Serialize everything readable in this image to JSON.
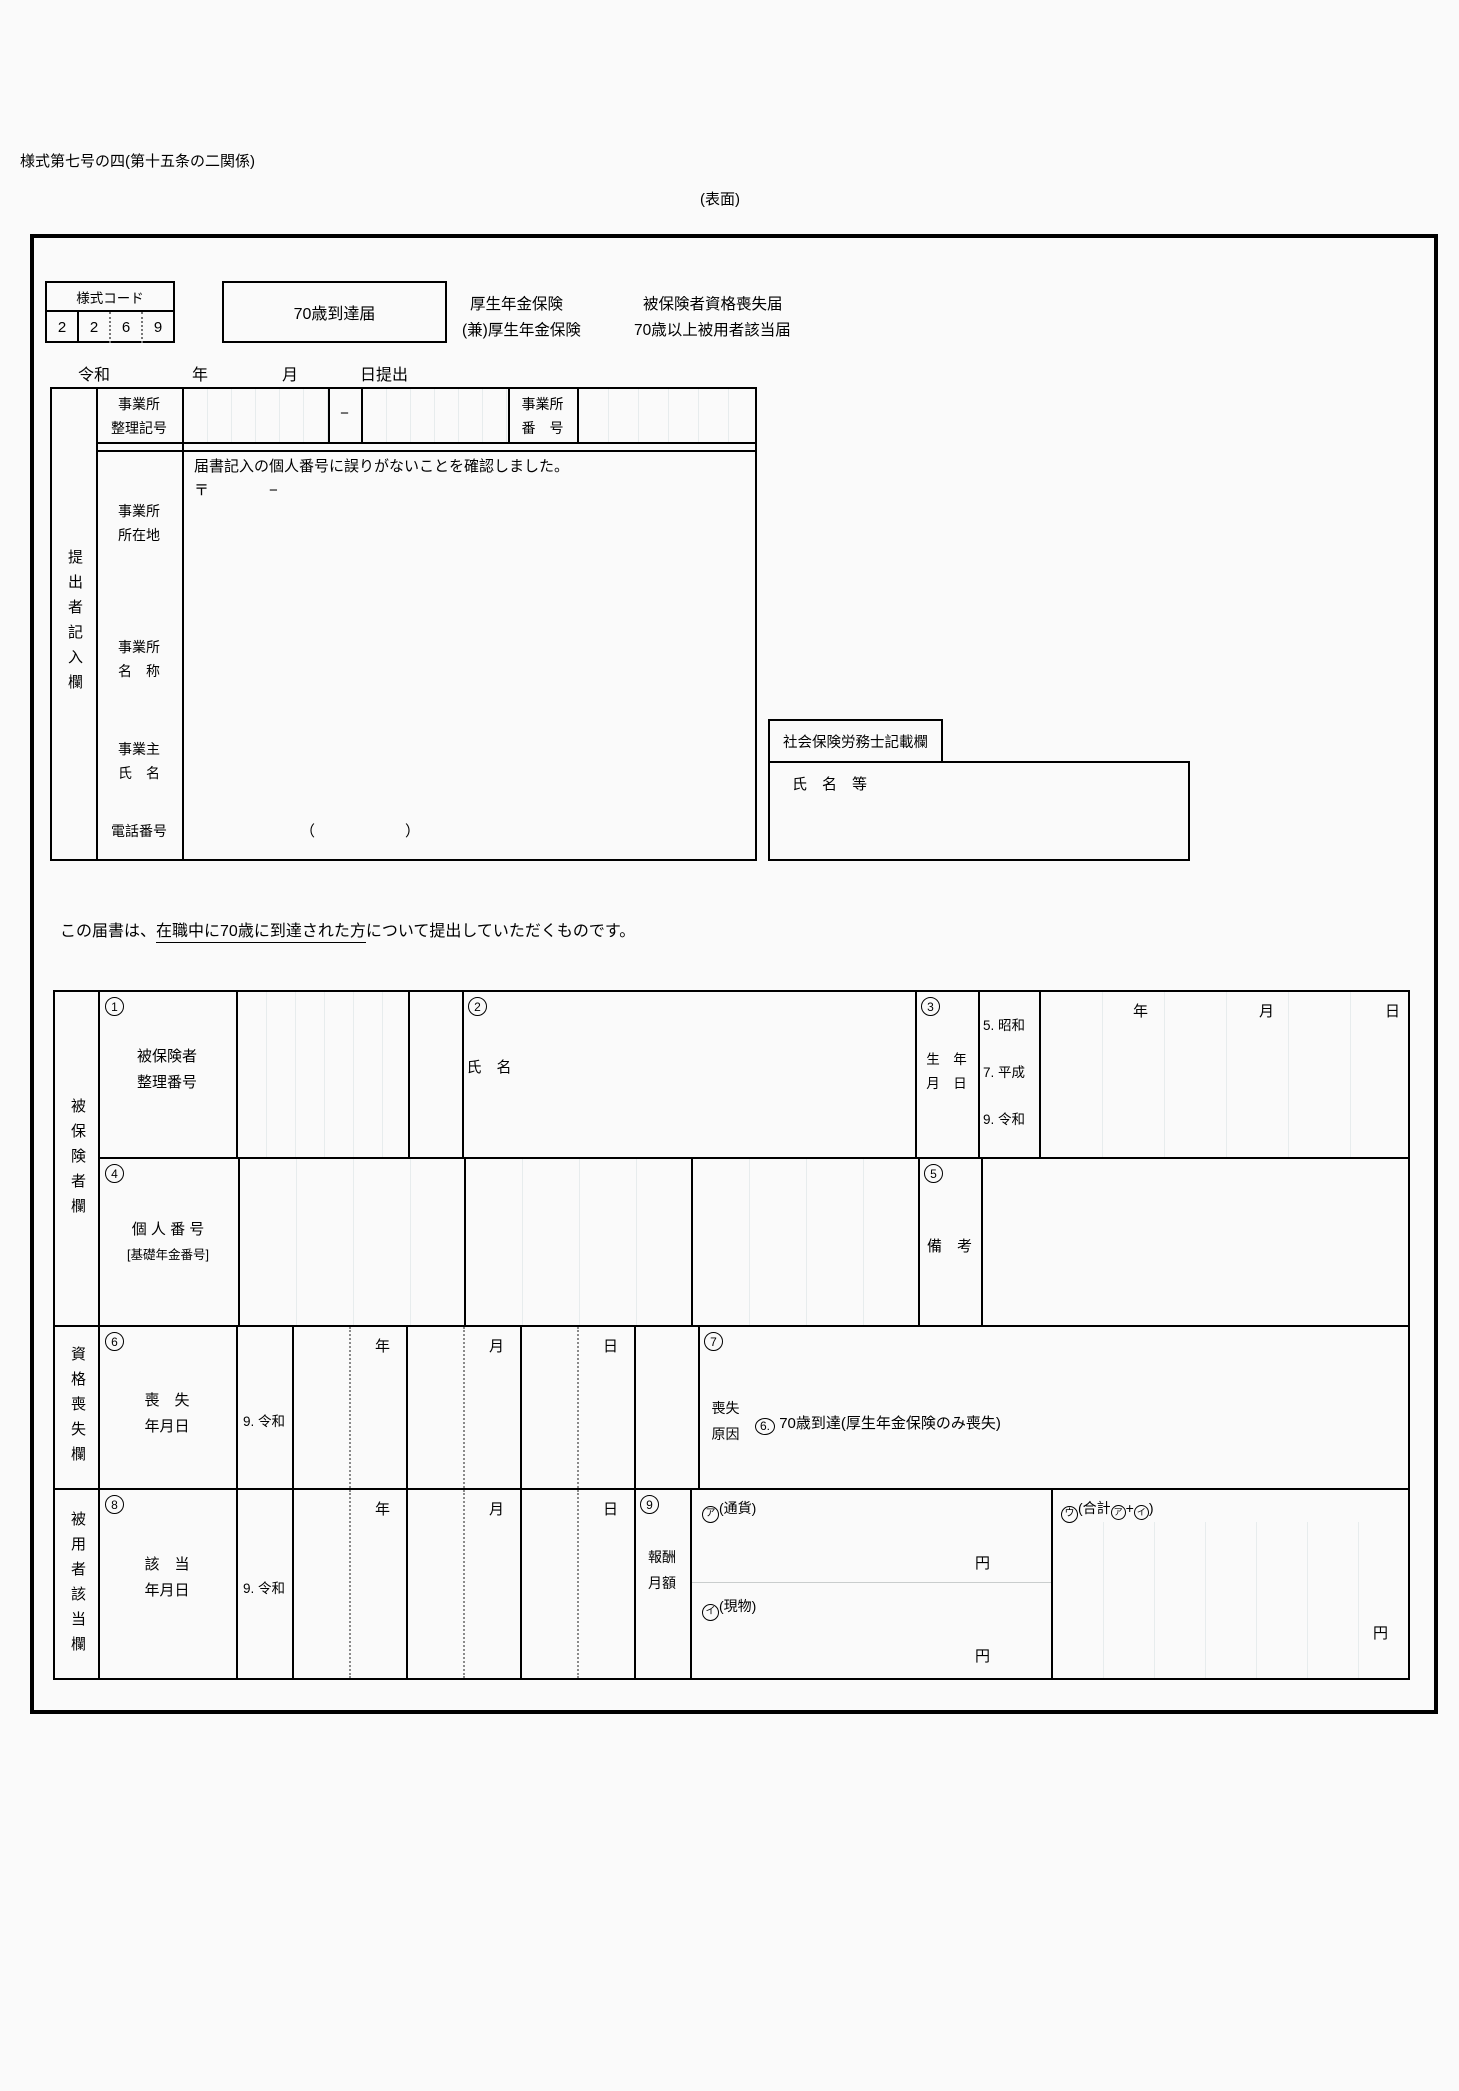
{
  "page": {
    "form_id": "様式第七号の四(第十五条の二関係)",
    "side": "(表面)"
  },
  "header": {
    "code_label": "様式コード",
    "code_digits": [
      "2",
      "2",
      "6",
      "9"
    ],
    "title_box": "70歳到達届",
    "line1_left": "厚生年金保険",
    "line1_right": "被保険者資格喪失届",
    "line2_left": "(兼)厚生年金保険",
    "line2_right": "70歳以上被用者該当届",
    "date_era": "令和",
    "date_year": "年",
    "date_month": "月",
    "date_day_submit": "日提出"
  },
  "submitter": {
    "section": "提出者記入欄",
    "office_code_label": "事業所\n整理記号",
    "dash": "−",
    "office_number_label": "事業所\n番　号",
    "note": "届書記入の個人番号に誤りがないことを確認しました。",
    "postal": "〒　　　　−",
    "address_label": "事業所\n所在地",
    "name_label": "事業所\n名　称",
    "owner_label": "事業主\n氏　名",
    "tel_label": "電話番号",
    "tel_paren": "（　　　　　　）"
  },
  "sharoushi": {
    "title": "社会保険労務士記載欄",
    "name_label": "氏　名　等"
  },
  "notice": {
    "pre": "この届書は、",
    "underlined": "在職中に70歳に到達された方",
    "post": "について提出していただくものです。"
  },
  "date_headers": {
    "y": "年",
    "m": "月",
    "d": "日"
  },
  "insured": {
    "section": "被保険者欄",
    "n1": "1",
    "l1": "被保険者\n整理番号",
    "n2": "2",
    "l2": "氏　名",
    "n3": "3",
    "l3": "生　年\n月　日",
    "eras": [
      "5. 昭和",
      "7. 平成",
      "9. 令和"
    ],
    "n4": "4",
    "l4a": "個 人 番 号",
    "l4b": "[基礎年金番号]",
    "n5": "5",
    "l5": "備　考"
  },
  "loss": {
    "section": "資格喪失欄",
    "n6": "6",
    "l6": "喪　失\n年月日",
    "era": "9. 令和",
    "n7": "7",
    "l7": "喪失\n原因",
    "reason_no": "6.",
    "reason": "70歳到達(厚生年金保険のみ喪失)"
  },
  "applicable": {
    "section": "被用者該当欄",
    "n8": "8",
    "l8": "該　当\n年月日",
    "era": "9. 令和",
    "n9": "9",
    "l9": "報酬\n月額",
    "a_mark": "ア",
    "a_label": "(通貨)",
    "b_mark": "イ",
    "b_label": "(現物)",
    "c_mark": "ウ",
    "c_pre": "(合計",
    "c_plus": "+",
    "c_post": ")",
    "yen": "円"
  }
}
